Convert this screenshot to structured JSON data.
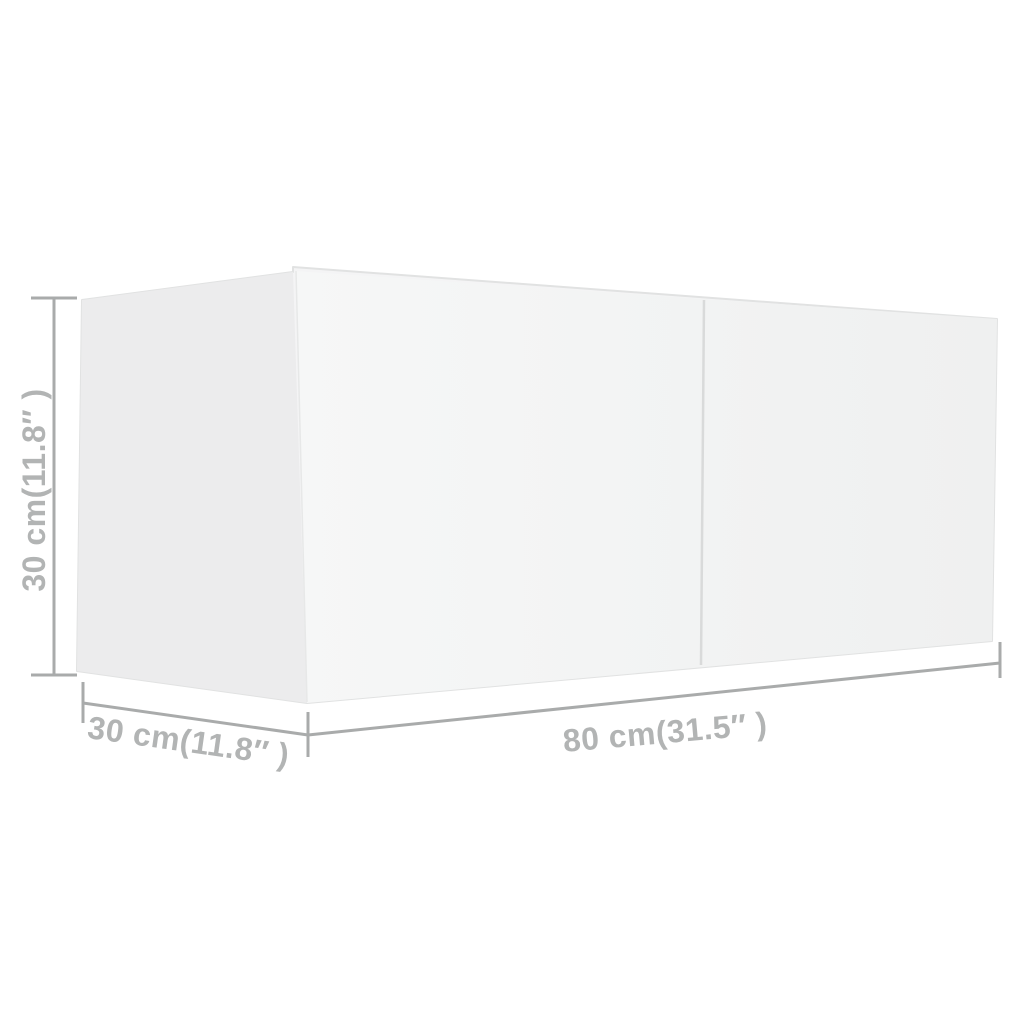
{
  "colors": {
    "background": "#ffffff",
    "left_face": "#ececed",
    "front_face_near": "#f6f7f7",
    "front_face_far": "#eff0f0",
    "top_sliver": "#f4f4f5",
    "outline": "#e1e2e2",
    "inner_edge": "#e7e8e8",
    "divider": "#d9dada",
    "dimension_line": "#a9abab",
    "dimension_text": "#b2b4b4"
  },
  "dimensions": {
    "height": {
      "label": "30 cm(11.8″ )"
    },
    "depth": {
      "label": "30 cm(11.8″ )"
    },
    "width": {
      "label": "80 cm(31.5″ )"
    }
  }
}
